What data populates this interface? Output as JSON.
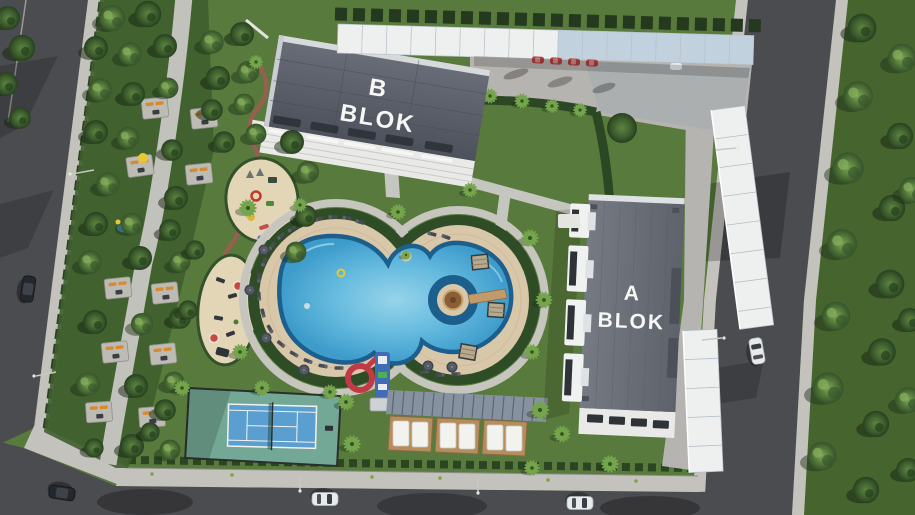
{
  "buildings": [
    {
      "id": "b-blok",
      "label_line1": "B",
      "label_line2": "BLOK"
    },
    {
      "id": "a-blok",
      "label_line1": "A",
      "label_line2": "BLOK"
    }
  ],
  "palette": {
    "grass": "#587a3c",
    "grass_dark": "#46652e",
    "road": "#4b4c50",
    "sidewalk": "#c3c2bd",
    "walkway": "#c2c2bc",
    "concrete": "#b5b4b0",
    "roof": "#6a6e78",
    "facade": "#eceff0",
    "canopy": "#eef0ef",
    "canopy_shaded": "#c2d1de",
    "pool_water": "#5fb5da",
    "pool_deep": "#1d5f8c",
    "deck": "#d8c7a9",
    "hedge": "#2e4c26",
    "court_green": "#74a896",
    "court_blue": "#5b9fd0",
    "sand": "#e3d6b6",
    "slide_red": "#c23a46",
    "slide_blue": "#3f6db5",
    "wood": "#b68d5c",
    "accent_orange": "#d98a2f",
    "car_white": "#e9eaec",
    "car_dark": "#24272c",
    "car_red": "#b33c3c"
  }
}
